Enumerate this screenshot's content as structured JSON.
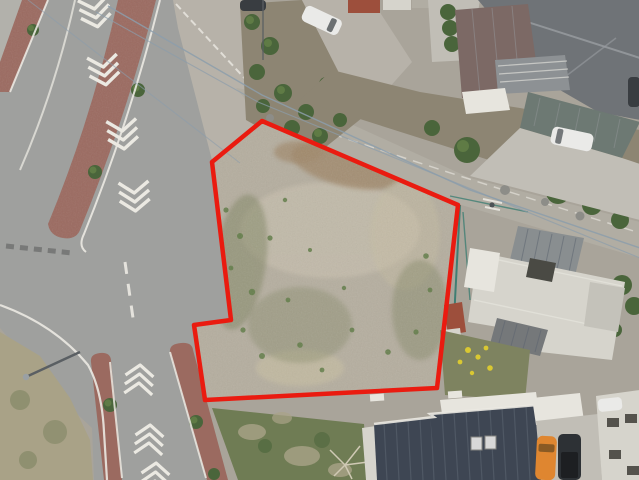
{
  "scene": {
    "description": "Aerial drone photograph of a vacant dirt land parcel outlined with a red boundary, beside a landscaped boulevard intersection, Japanese houses with tiled roofs, gardens and parked cars",
    "boundary": {
      "points": "262,121 212,162 231,320 194,325 205,400 437,388 458,205",
      "color": "#ea1b10",
      "stroke_width": 4.5
    }
  },
  "colors": {
    "base": "#a9a49a",
    "asphalt": "#9fa09e",
    "pavement_light": "#bab6ae",
    "sidewalk": "#b2b1ab",
    "brick": "#9b6a60",
    "marking": "#ebe9e2",
    "dirt": "#b5ae9f",
    "dirt_brown": "#a0886a",
    "dirt_light": "#c4bcab",
    "dirt_sand": "#c8bfa2",
    "weed": "#7e8360",
    "grass": "#6f7c54",
    "grass_dead": "#a9a287",
    "bush": "#4a653b",
    "bush_hi": "#5f7b45",
    "soil": "#8d8573",
    "gravel": "#b7b2a9",
    "gravel2": "#b1ada3",
    "roof_gray": "#6f7377",
    "roof_ridge": "#9a9da1",
    "roof_brown": "#7c6965",
    "roof_green": "#6d7973",
    "roof_navy": "#3e4653",
    "seam_navy": "#57606c",
    "white_bld": "#d6d4cc",
    "white_hi": "#e7e5de",
    "concrete": "#c1beb6",
    "car_white": "#eaeae8",
    "car_orange": "#df8630",
    "car_black": "#2d3135",
    "car_dark": "#393d41",
    "wire": "#8c9dab",
    "teal": "#3f7e73",
    "shed_red": "#9d4f3c",
    "flower": "#d9c832",
    "pole": "#5a5f63",
    "window_dark": "#54524c"
  }
}
